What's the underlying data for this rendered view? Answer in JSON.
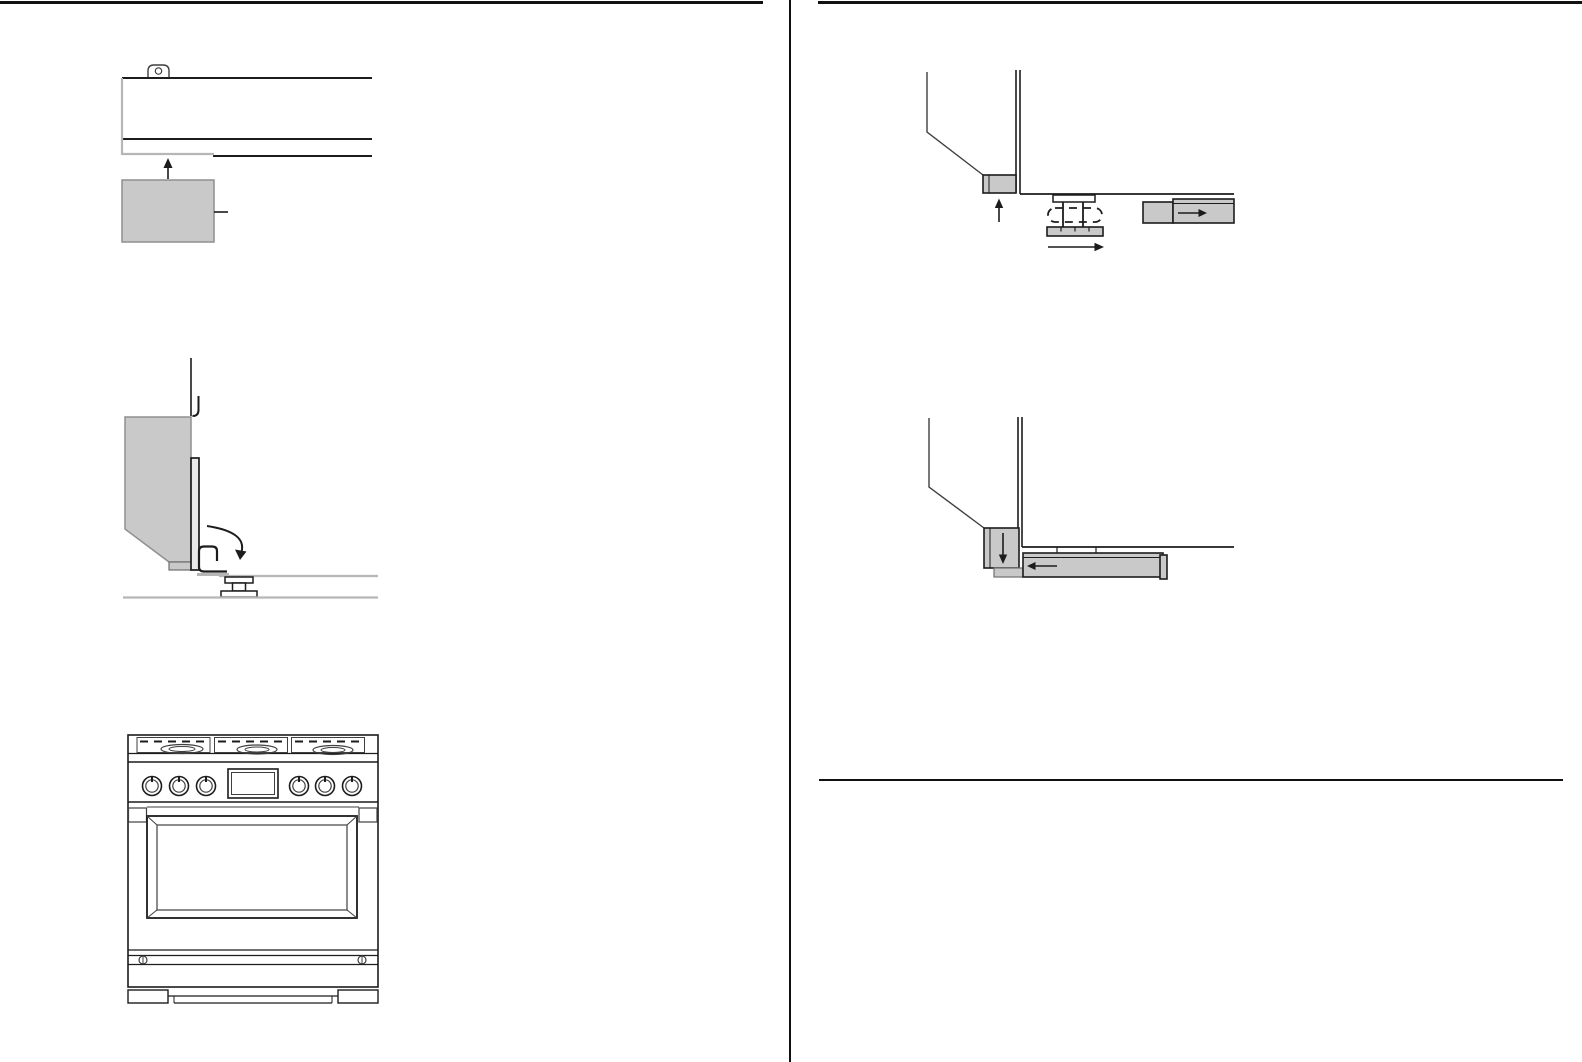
{
  "document": {
    "kind": "appliance-installation-manual-page",
    "visible_text": [],
    "columns": 2
  },
  "colors": {
    "background": "#ffffff",
    "rule": "#111111",
    "ink": "#1c1c1c",
    "soft_ink": "#3f3f3f",
    "gray_fill": "#c9c9c9",
    "gray_fill_dark": "#bdbdbd",
    "gray_line": "#b6b6b6",
    "panel_edge_fill": "#e9e9e9"
  },
  "figures": {
    "left_top": {
      "id": "bracket-slide-up-under-range-base",
      "icons": [
        "up-arrow"
      ],
      "parts": [
        "mounting-tab-with-hole",
        "range-base-rail",
        "bracket-block",
        "callout-tick"
      ]
    },
    "left_middle": {
      "id": "kick-panel-hook-and-rotate",
      "icons": [
        "rotate-down-arrow"
      ],
      "parts": [
        "side-panel",
        "panel-edge",
        "hook-bracket",
        "leveling-foot",
        "counter-line",
        "floor-line"
      ]
    },
    "left_bottom": {
      "id": "range-front-view",
      "burners": 3,
      "knobs": 6,
      "displays": 1,
      "parts": [
        "cooktop-grates",
        "control-panel",
        "oven-door-window",
        "storage-drawer",
        "feet"
      ]
    },
    "right_top": {
      "id": "leveling-leg-lift-and-slide",
      "icons": [
        "up-arrow",
        "slide-right-arrow",
        "kick-plate-right-arrow"
      ],
      "parts": [
        "range-corner-profile",
        "corner-bracket",
        "leveling-leg",
        "dashed-leg-outline",
        "leg-base",
        "kick-plate-block",
        "kick-plate-bar"
      ]
    },
    "right_middle": {
      "id": "kick-plate-attach",
      "icons": [
        "down-arrow",
        "kick-plate-left-arrow"
      ],
      "parts": [
        "range-corner-profile",
        "corner-bracket",
        "bracket-foot-strip",
        "kick-plate-bar",
        "end-cap"
      ]
    }
  }
}
